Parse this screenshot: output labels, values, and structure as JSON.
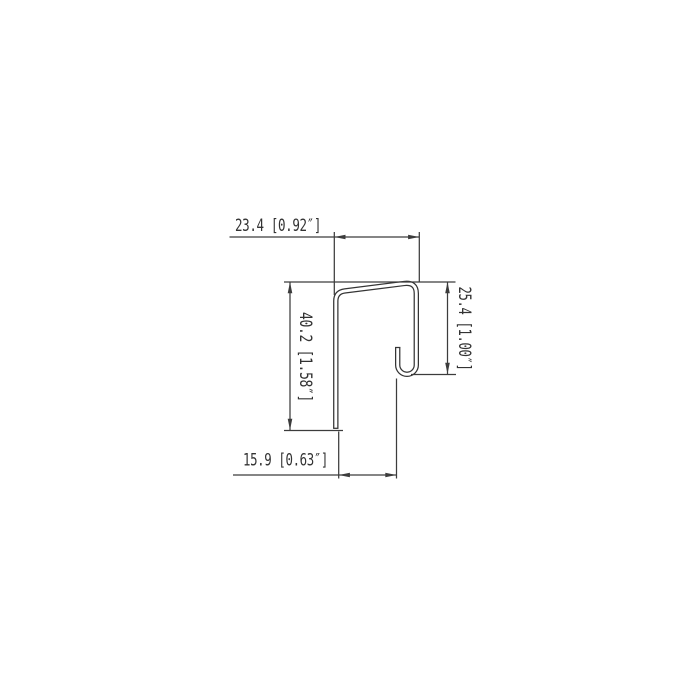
{
  "drawing": {
    "type": "sheet-metal-profile-cross-section",
    "background_color": "#ffffff",
    "line_color": "#3c3c3c",
    "profile_line_color": "#353535",
    "text_color": "#333333",
    "dimensions": {
      "top_width": {
        "label": "23.4 [0.92″]",
        "mm": "23.4",
        "inches": "0.92"
      },
      "left_height": {
        "label": "40.2 [1.58″]",
        "mm": "40.2",
        "inches": "1.58"
      },
      "right_height": {
        "label": "25.4 [1.00″]",
        "mm": "25.4",
        "inches": "1.00"
      },
      "bottom_width": {
        "label": "15.9 [0.63″]",
        "mm": "15.9",
        "inches": "0.63"
      }
    }
  }
}
